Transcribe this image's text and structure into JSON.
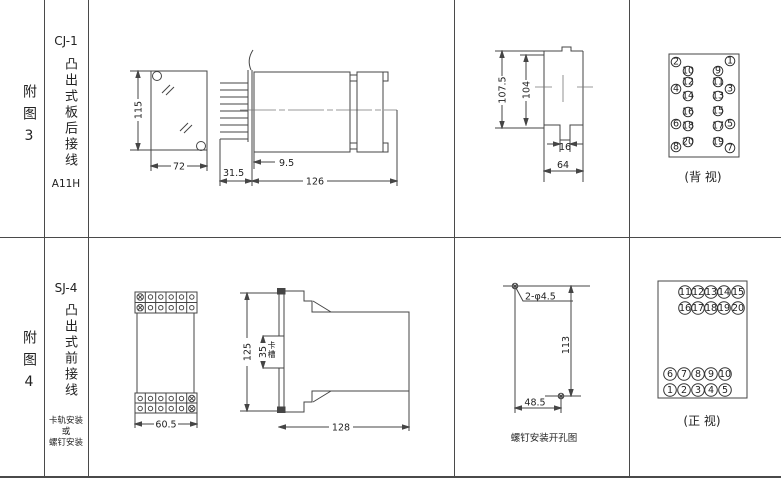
{
  "fig3": {
    "row_label": "附图3",
    "model": "CJ-1",
    "mount_title": "凸出式板后接线",
    "code": "A11H",
    "front_view": {
      "height": "115",
      "width": "72"
    },
    "side_view": {
      "pin_length": "31.5",
      "flange_offset": "9.5",
      "body_length": "126"
    },
    "panel_cutout": {
      "outer_height": "107.5",
      "inner_height": "104",
      "notch_width": "16",
      "width": "64"
    },
    "terminal_view": {
      "caption": "(背 视)",
      "pins": [
        {
          "n": "2",
          "x": 21,
          "y": 17
        },
        {
          "n": "1",
          "x": 75,
          "y": 16
        },
        {
          "n": "10",
          "x": 33,
          "y": 26
        },
        {
          "n": "9",
          "x": 63,
          "y": 26
        },
        {
          "n": "12",
          "x": 33,
          "y": 37
        },
        {
          "n": "11",
          "x": 63,
          "y": 37
        },
        {
          "n": "4",
          "x": 21,
          "y": 44
        },
        {
          "n": "3",
          "x": 75,
          "y": 44
        },
        {
          "n": "14",
          "x": 33,
          "y": 51
        },
        {
          "n": "13",
          "x": 63,
          "y": 51
        },
        {
          "n": "16",
          "x": 33,
          "y": 67
        },
        {
          "n": "15",
          "x": 63,
          "y": 66
        },
        {
          "n": "6",
          "x": 21,
          "y": 79
        },
        {
          "n": "5",
          "x": 75,
          "y": 79
        },
        {
          "n": "18",
          "x": 33,
          "y": 81
        },
        {
          "n": "17",
          "x": 63,
          "y": 81
        },
        {
          "n": "20",
          "x": 33,
          "y": 97
        },
        {
          "n": "19",
          "x": 63,
          "y": 97
        },
        {
          "n": "8",
          "x": 21,
          "y": 102
        },
        {
          "n": "7",
          "x": 75,
          "y": 103
        }
      ]
    }
  },
  "fig4": {
    "row_label": "附图4",
    "model": "SJ-4",
    "mount_title": "凸出式前接线",
    "mount_note": [
      "卡轨安装",
      "或",
      "螺钉安装"
    ],
    "front_view": {
      "width": "60.5"
    },
    "side_view": {
      "height": "125",
      "slot_height": "35",
      "slot_label": "卡槽",
      "body_length": "128"
    },
    "drill_view": {
      "holes_label": "2-φ4.5",
      "height": "113",
      "width": "48.5",
      "caption": "螺钉安装开孔图"
    },
    "terminal_view": {
      "caption": "(正 视)",
      "pins": [
        {
          "n": "11",
          "x": 35,
          "y": 17
        },
        {
          "n": "12",
          "x": 48,
          "y": 17
        },
        {
          "n": "13",
          "x": 61,
          "y": 17
        },
        {
          "n": "14",
          "x": 74,
          "y": 17
        },
        {
          "n": "15",
          "x": 88,
          "y": 17
        },
        {
          "n": "16",
          "x": 35,
          "y": 33
        },
        {
          "n": "17",
          "x": 48,
          "y": 33
        },
        {
          "n": "18",
          "x": 61,
          "y": 33
        },
        {
          "n": "19",
          "x": 74,
          "y": 33
        },
        {
          "n": "20",
          "x": 88,
          "y": 33
        },
        {
          "n": "6",
          "x": 20,
          "y": 99
        },
        {
          "n": "7",
          "x": 34,
          "y": 99
        },
        {
          "n": "8",
          "x": 48,
          "y": 99
        },
        {
          "n": "9",
          "x": 61,
          "y": 99
        },
        {
          "n": "10",
          "x": 75,
          "y": 99
        },
        {
          "n": "1",
          "x": 20,
          "y": 115
        },
        {
          "n": "2",
          "x": 34,
          "y": 115
        },
        {
          "n": "3",
          "x": 48,
          "y": 115
        },
        {
          "n": "4",
          "x": 61,
          "y": 115
        },
        {
          "n": "5",
          "x": 75,
          "y": 115
        }
      ]
    }
  }
}
